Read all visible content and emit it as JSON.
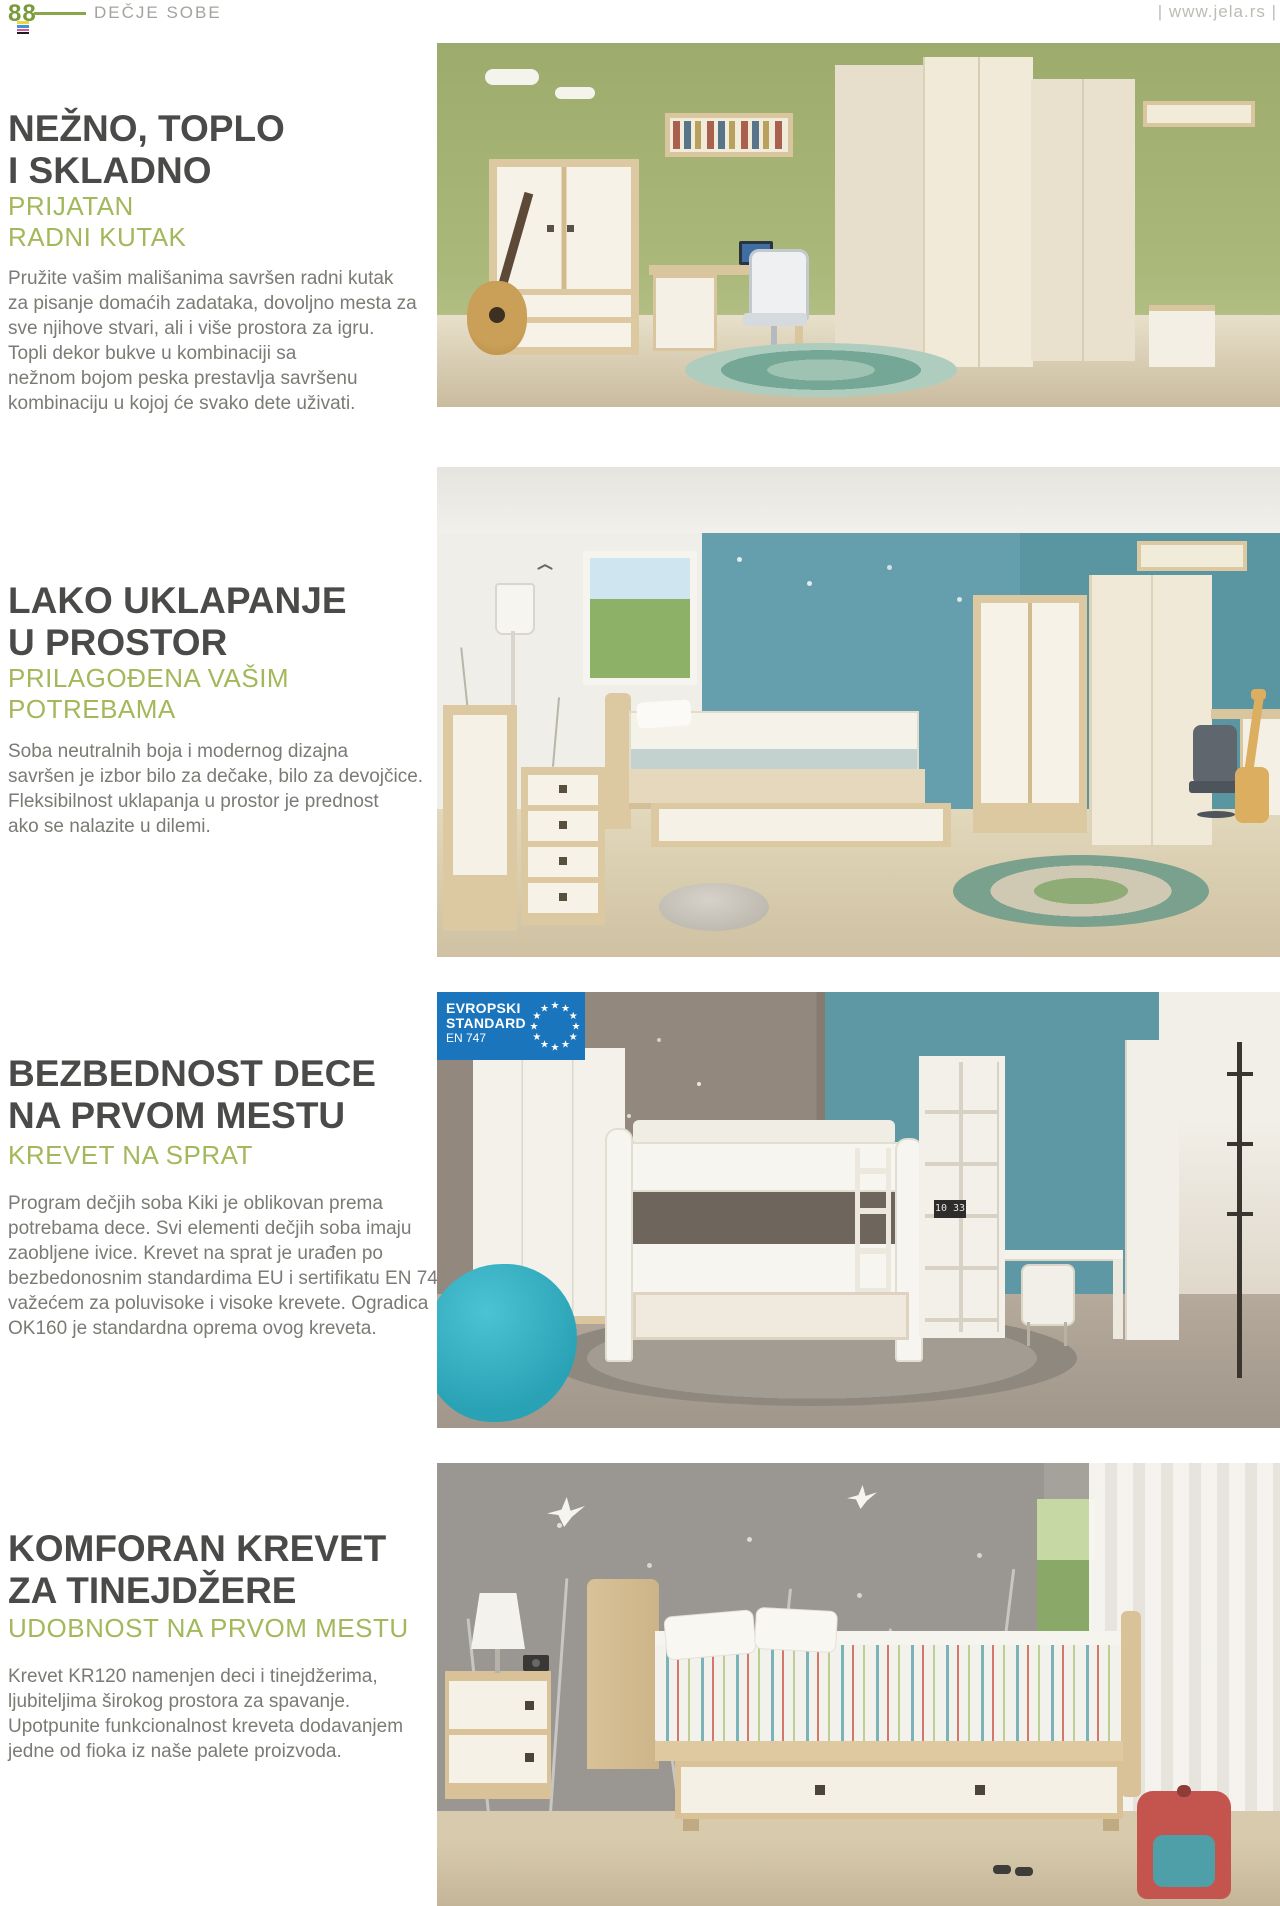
{
  "page": {
    "number": "88",
    "category": "DEČJE SOBE",
    "website": "| www.jela.rs |"
  },
  "colors": {
    "accent_green": "#a3b85a",
    "page_number_green": "#7a9a3c",
    "heading_gray": "#4a4a48",
    "body_gray": "#7c7a74",
    "badge_blue": "#1a75bc"
  },
  "badge": {
    "line1": "EVROPSKI",
    "line2": "STANDARD",
    "line3": "EN 747"
  },
  "photos": {
    "clock_time": "10 33"
  },
  "sections": [
    {
      "heading": "NEŽNO, TOPLO\nI SKLADNO",
      "subheading": "PRIJATAN\nRADNI KUTAK",
      "body": "Pružite vašim mališanima savršen radni kutak\nza pisanje domaćih zadataka, dovoljno mesta za\nsve njihove stvari, ali i više prostora za igru.\nTopli dekor bukve u kombinaciji sa\nnežnom bojom peska prestavlja savršenu\nkombinaciju u kojoj će svako dete uživati."
    },
    {
      "heading": "LAKO UKLAPANJE\nU PROSTOR",
      "subheading": "PRILAGOĐENA VAŠIM\nPOTREBAMA",
      "body": "Soba neutralnih boja i modernog dizajna\nsavršen je izbor bilo za dečake, bilo za devojčice.\nFleksibilnost uklapanja u prostor je prednost\nako se nalazite u dilemi."
    },
    {
      "heading": "BEZBEDNOST DECE\nNA PRVOM MESTU",
      "subheading": "KREVET NA SPRAT",
      "body": "Program dečjih soba Kiki je oblikovan prema\npotrebama dece. Svi elementi dečjih soba imaju\nzaobljene ivice. Krevet na sprat je urađen po\nbezbedonosnim standardima EU i sertifikatu EN 747,\nvažećem za poluvisoke i visoke krevete. Ogradica\nOK160 je standardna oprema ovog kreveta."
    },
    {
      "heading": "KOMFORAN KREVET\nZA TINEJDŽERE",
      "subheading": "UDOBNOST NA PRVOM MESTU",
      "body": "Krevet KR120 namenjen deci i tinejdžerima,\nljubiteljima širokog prostora za spavanje.\nUpotpunite funkcionalnost kreveta dodavanjem\njedne od fioka iz naše palete proizvoda."
    }
  ]
}
